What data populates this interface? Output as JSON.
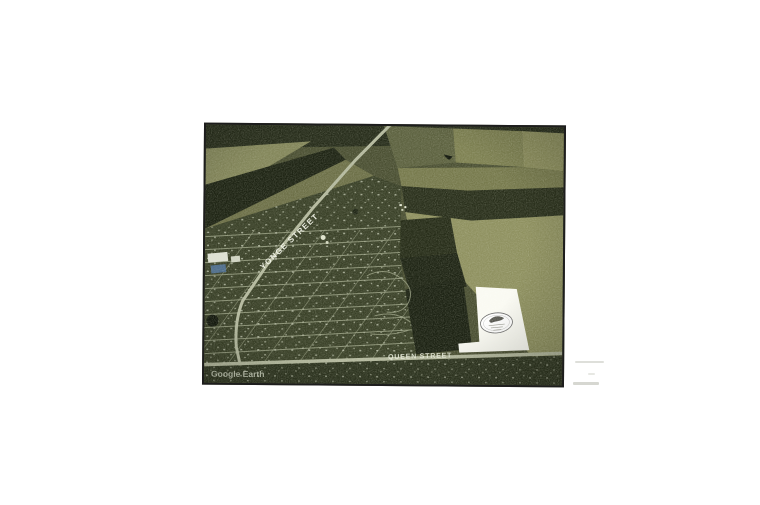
{
  "page": {
    "background": "#ffffff"
  },
  "aerial_photo": {
    "watermark": "Google Earth",
    "street_labels": {
      "yonge": "YONGE STREET",
      "queen": "QUEEN STREET"
    },
    "parcel": {
      "fill": "#fbfbf4",
      "outline": "#161616"
    },
    "palette": {
      "base": "#4b5033",
      "field_light": "#8f9160",
      "field_mid": "#7e8152",
      "field_olive": "#6d7048",
      "field_dark": "#2a301c",
      "field_very_dark": "#1e2414",
      "town_base": "#3a4128",
      "road": "#b4b99e",
      "frame_border": "#1d1d1d"
    }
  }
}
